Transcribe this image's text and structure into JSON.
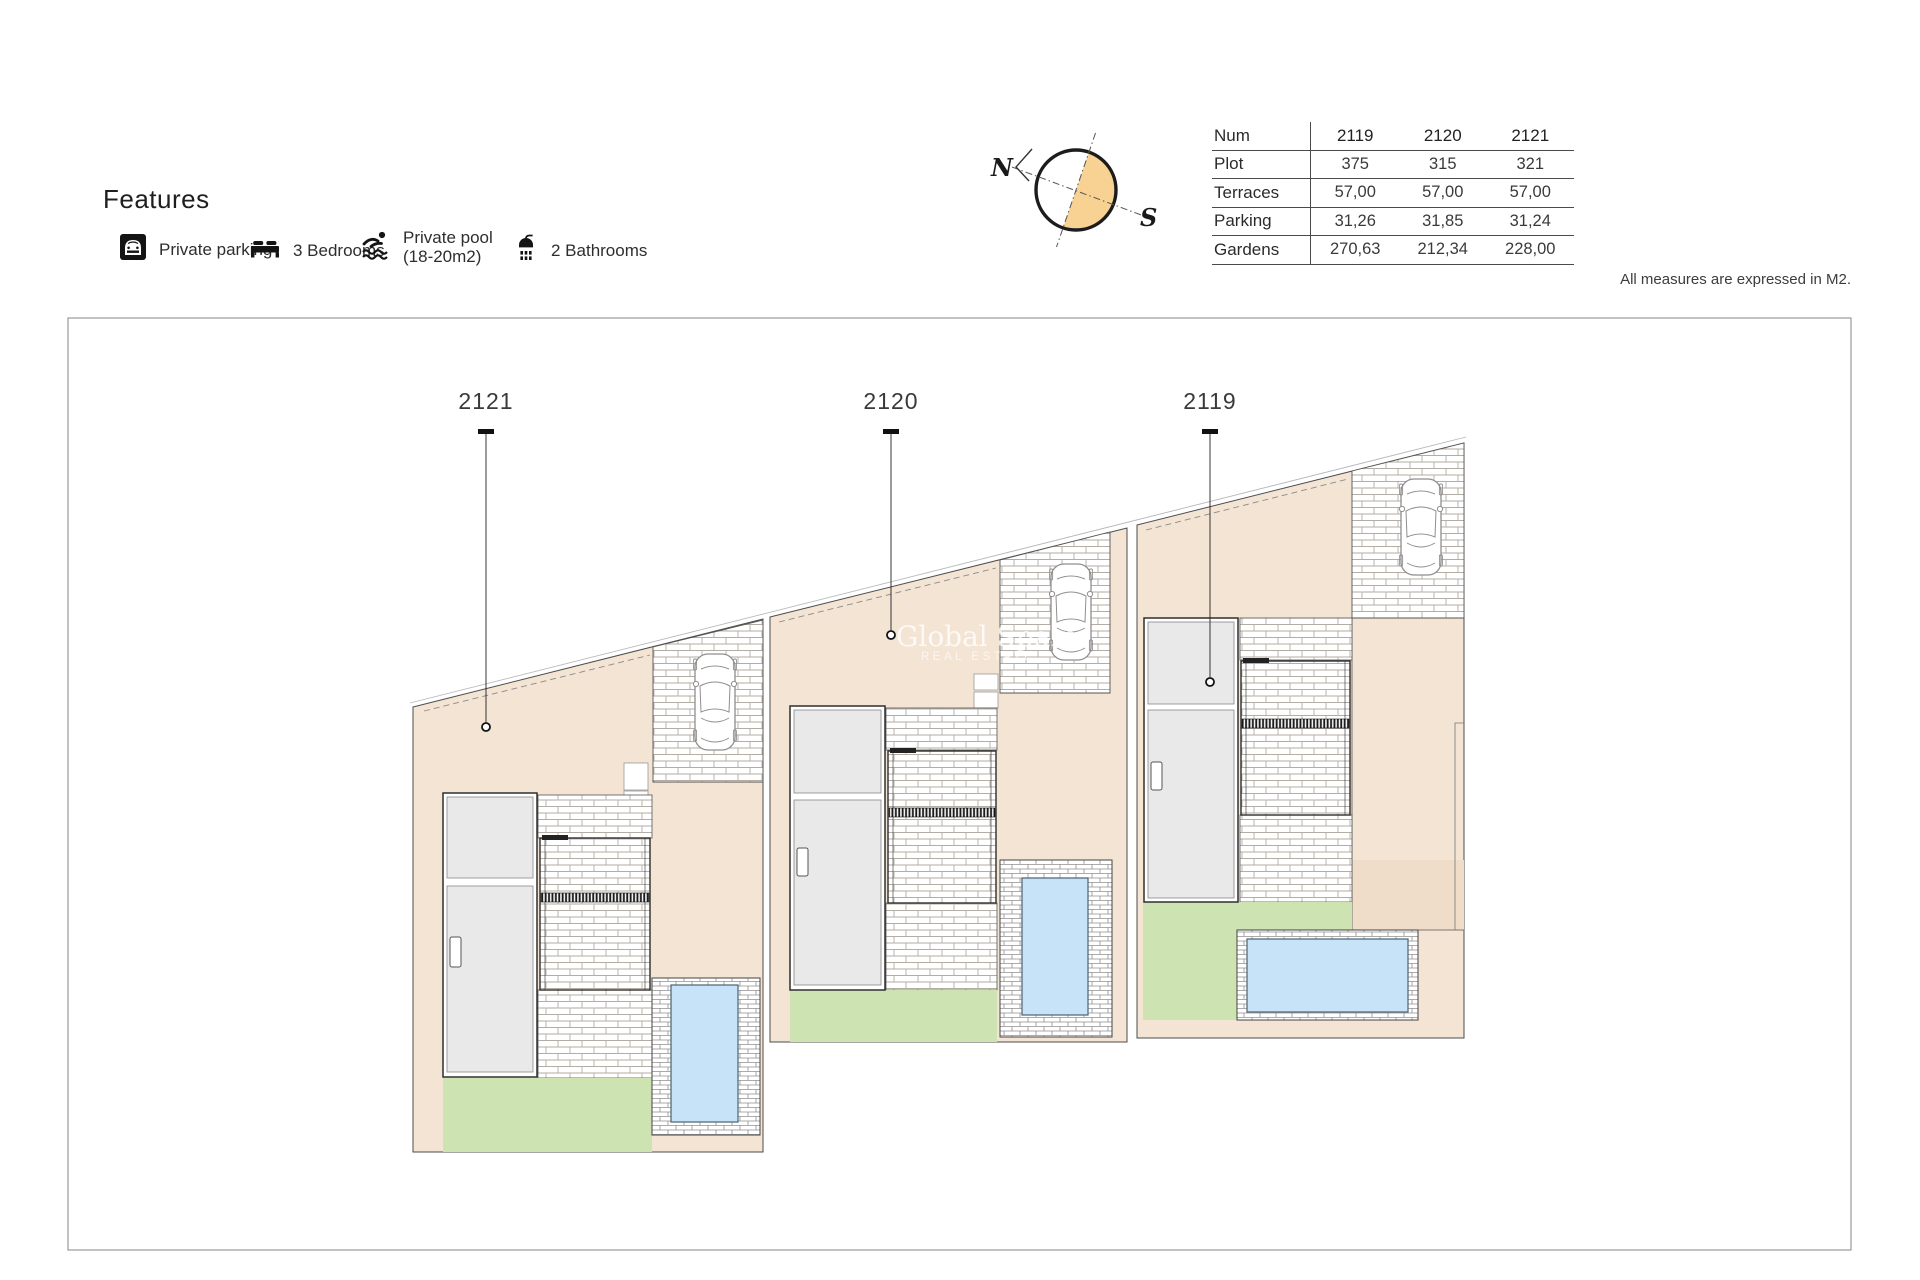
{
  "features": {
    "title": "Features",
    "items": [
      {
        "icon": "parking-icon",
        "label": "Private parking"
      },
      {
        "icon": "bed-icon",
        "label": "3 Bedrooms"
      },
      {
        "icon": "pool-icon",
        "label": "Private pool",
        "label2": "(18-20m2)"
      },
      {
        "icon": "shower-icon",
        "label": "2 Bathrooms"
      }
    ]
  },
  "compass": {
    "north": "N",
    "south": "S",
    "accent": "#f8d292"
  },
  "table": {
    "rows": [
      {
        "label": "Num",
        "values": [
          "2119",
          "2120",
          "2121"
        ]
      },
      {
        "label": "Plot",
        "values": [
          "375",
          "315",
          "321"
        ]
      },
      {
        "label": "Terraces",
        "values": [
          "57,00",
          "57,00",
          "57,00"
        ]
      },
      {
        "label": "Parking",
        "values": [
          "31,26",
          "31,85",
          "31,24"
        ]
      },
      {
        "label": "Gardens",
        "values": [
          "270,63",
          "212,34",
          "228,00"
        ]
      }
    ]
  },
  "note": "All measures are expressed in M2.",
  "watermark": {
    "line1": "Global Spain",
    "line2": "REAL ESTATE"
  },
  "plan": {
    "plots": [
      {
        "label": "2121"
      },
      {
        "label": "2120"
      },
      {
        "label": "2119"
      }
    ]
  },
  "colors": {
    "beige": "#f3e4d4",
    "beige_dark": "#efddc9",
    "garden_green": "#cde3b1",
    "pool_blue": "#c6e3f8",
    "compass_orange": "#f8d292"
  }
}
